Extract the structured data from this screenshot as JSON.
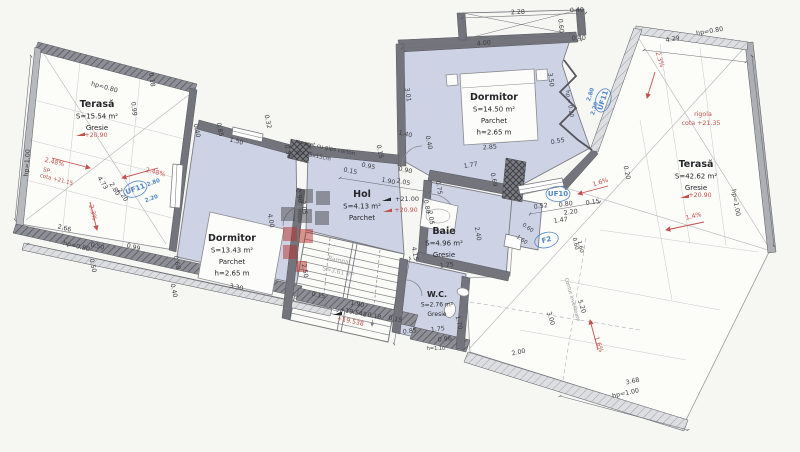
{
  "plan": {
    "language": "Romanian",
    "colors": {
      "paper": "#f6f6f3",
      "room_fill": "#cdd3e5",
      "wall": "#74757c",
      "wall_dark": "#55565c",
      "terrace_fill": "#fcfcf9",
      "dim_text": "#3c3d42",
      "red_annotation": "#c2504b",
      "blue_annotation": "#4f86c6"
    },
    "rooms": [
      {
        "name": "Terasă",
        "area": "S=15.54 m²",
        "finish": "Gresie",
        "x": 97,
        "y": 107
      },
      {
        "name": "Dormitor",
        "area": "S=13.43 m²",
        "finish": "Parchet",
        "height": "h=2.65 m",
        "x": 232,
        "y": 241
      },
      {
        "name": "Hol",
        "area": "S=4.13 m²",
        "finish": "Parchet",
        "x": 362,
        "y": 197
      },
      {
        "name": "Dormitor",
        "area": "S=14.50 m²",
        "finish": "Parchet",
        "height": "h=2.65 m",
        "x": 494,
        "y": 100
      },
      {
        "name": "Baie",
        "area": "S=4.96 m²",
        "finish": "Gresie",
        "x": 444,
        "y": 234
      },
      {
        "name": "W.C.",
        "area": "S=2.76 m²",
        "finish": "Gresie",
        "x": 437,
        "y": 297,
        "small": 1
      },
      {
        "name": "Terasă",
        "area": "S=42.62 m²",
        "finish": "Gresie",
        "x": 696,
        "y": 167
      },
      {
        "name": "Rampa",
        "area": "S=3.61 m²",
        "x": 338,
        "y": 262,
        "r": 12,
        "muted": 1
      }
    ],
    "dimensions": [
      {
        "t": "2.28",
        "x": 518,
        "y": 14,
        "r": -3
      },
      {
        "t": "0.40",
        "x": 577,
        "y": 12,
        "r": -3
      },
      {
        "t": "0.60",
        "x": 559,
        "y": 26,
        "r": 84
      },
      {
        "t": "0.40",
        "x": 579,
        "y": 40,
        "r": -3
      },
      {
        "t": "4.00",
        "x": 484,
        "y": 45,
        "r": -5
      },
      {
        "t": "4.29",
        "x": 673,
        "y": 41,
        "r": -10
      },
      {
        "t": "hp=0.80",
        "x": 710,
        "y": 33,
        "r": -10
      },
      {
        "t": "hp=0.80",
        "x": 104,
        "y": 89,
        "r": 15
      },
      {
        "t": "0.18",
        "x": 150,
        "y": 80,
        "r": 82
      },
      {
        "t": "0.99",
        "x": 132,
        "y": 109,
        "r": 84
      },
      {
        "t": "hp=1.00",
        "x": 29,
        "y": 163,
        "r": -86
      },
      {
        "t": "4.73",
        "x": 101,
        "y": 184,
        "r": 58
      },
      {
        "t": "2.80",
        "x": 113,
        "y": 190,
        "r": 58
      },
      {
        "t": "2.20",
        "x": 121,
        "y": 196,
        "r": 58
      },
      {
        "t": "2.66",
        "x": 64,
        "y": 230,
        "r": 14
      },
      {
        "t": "hp=0.80",
        "x": 76,
        "y": 248,
        "r": 14
      },
      {
        "t": "0.50",
        "x": 97,
        "y": 248,
        "r": 14
      },
      {
        "t": "0.99",
        "x": 133,
        "y": 249,
        "r": 14
      },
      {
        "t": "0.50",
        "x": 91,
        "y": 266,
        "r": 78
      },
      {
        "t": "0.60",
        "x": 175,
        "y": 263,
        "r": 78
      },
      {
        "t": "0.40",
        "x": 172,
        "y": 291,
        "r": 78
      },
      {
        "t": "0.40",
        "x": 195,
        "y": 131,
        "r": 78
      },
      {
        "t": "0.85",
        "x": 218,
        "y": 130,
        "r": 78
      },
      {
        "t": "1.50",
        "x": 236,
        "y": 143,
        "r": 14
      },
      {
        "t": "0.32",
        "x": 266,
        "y": 122,
        "r": 78
      },
      {
        "t": "0.36",
        "x": 286,
        "y": 152,
        "r": 78
      },
      {
        "t": "mascat cu gips carton",
        "x": 325,
        "y": 149,
        "r": 12,
        "s": 5.5
      },
      {
        "t": "gol 25x15cm",
        "x": 313,
        "y": 157,
        "r": 12,
        "s": 5.5
      },
      {
        "t": "3.30",
        "x": 236,
        "y": 289,
        "r": 12
      },
      {
        "t": "0.90",
        "x": 297,
        "y": 196,
        "r": 80
      },
      {
        "t": "2.05",
        "x": 302,
        "y": 208,
        "r": 80
      },
      {
        "t": "4.00",
        "x": 269,
        "y": 221,
        "r": 80
      },
      {
        "t": "2.50",
        "x": 303,
        "y": 271,
        "r": 80
      },
      {
        "t": "4.15",
        "x": 413,
        "y": 254,
        "r": 80
      },
      {
        "t": "0.15",
        "x": 350,
        "y": 173,
        "r": 12
      },
      {
        "t": "0.95",
        "x": 368,
        "y": 168,
        "r": 12
      },
      {
        "t": "1.90",
        "x": 388,
        "y": 183,
        "r": 12
      },
      {
        "t": "2.05",
        "x": 403,
        "y": 184,
        "r": 12
      },
      {
        "t": "0.90",
        "x": 405,
        "y": 172,
        "r": 12
      },
      {
        "t": "1.40",
        "x": 405,
        "y": 136,
        "r": 12
      },
      {
        "t": "0.40",
        "x": 427,
        "y": 143,
        "r": 78
      },
      {
        "t": "0.15",
        "x": 378,
        "y": 152,
        "r": 78
      },
      {
        "t": "+21.00",
        "x": 407,
        "y": 201,
        "s": 6.5
      },
      {
        "t": "2.85",
        "x": 490,
        "y": 149,
        "r": -4
      },
      {
        "t": "1.77",
        "x": 471,
        "y": 167,
        "r": -10
      },
      {
        "t": "0.69",
        "x": 492,
        "y": 180,
        "r": 78
      },
      {
        "t": "3.50",
        "x": 549,
        "y": 80,
        "r": 82
      },
      {
        "t": "3.01",
        "x": 406,
        "y": 95,
        "r": 82
      },
      {
        "t": "0.55",
        "x": 558,
        "y": 143,
        "r": -10
      },
      {
        "t": "hp = 0.20",
        "x": 568,
        "y": 104,
        "r": 80,
        "s": 5.5
      },
      {
        "t": "0.75",
        "x": 437,
        "y": 188,
        "r": 80
      },
      {
        "t": "0.80",
        "x": 425,
        "y": 207,
        "r": 80
      },
      {
        "t": "2.05",
        "x": 429,
        "y": 218,
        "r": 80
      },
      {
        "t": "2.40",
        "x": 476,
        "y": 234,
        "r": 80
      },
      {
        "t": "0.52",
        "x": 541,
        "y": 208,
        "r": -8
      },
      {
        "t": "0.80",
        "x": 566,
        "y": 206,
        "r": -8
      },
      {
        "t": "2.20",
        "x": 571,
        "y": 214,
        "r": -8
      },
      {
        "t": "1.47",
        "x": 561,
        "y": 222,
        "r": -8
      },
      {
        "t": "0.15",
        "x": 593,
        "y": 204,
        "r": -8
      },
      {
        "t": "0.60",
        "x": 527,
        "y": 229,
        "r": 35,
        "s": 5.5
      },
      {
        "t": "1.60",
        "x": 521,
        "y": 241,
        "r": 35,
        "s": 5.5
      },
      {
        "t": "0.60",
        "x": 574,
        "y": 244,
        "r": 78,
        "s": 5.5
      },
      {
        "t": "1.60",
        "x": 579,
        "y": 247,
        "r": 78,
        "s": 5.5
      },
      {
        "t": "0.20",
        "x": 625,
        "y": 173,
        "r": 78
      },
      {
        "t": "1.75",
        "x": 447,
        "y": 267,
        "r": -6
      },
      {
        "t": "1.75",
        "x": 438,
        "y": 331,
        "r": -6
      },
      {
        "t": "0.85",
        "x": 410,
        "y": 333,
        "r": -6
      },
      {
        "t": "1.70",
        "x": 457,
        "y": 323,
        "r": 78
      },
      {
        "t": "0.96",
        "x": 445,
        "y": 341,
        "r": -6
      },
      {
        "t": "h=1.10",
        "x": 436,
        "y": 350,
        "s": 5
      },
      {
        "t": "0.18",
        "x": 374,
        "y": 318,
        "r": 12
      },
      {
        "t": "0.15",
        "x": 395,
        "y": 321,
        "r": 12
      },
      {
        "t": "0.15",
        "x": 318,
        "y": 297,
        "r": 12
      },
      {
        "t": "1.90",
        "x": 357,
        "y": 306,
        "r": 12
      },
      {
        "t": "+19.548",
        "x": 353,
        "y": 314,
        "r": 12
      },
      {
        "t": "2.00",
        "x": 519,
        "y": 354,
        "r": -12
      },
      {
        "t": "3.00",
        "x": 549,
        "y": 319,
        "r": 72
      },
      {
        "t": "5.20",
        "x": 580,
        "y": 307,
        "r": 72
      },
      {
        "t": "Contur învelitoare",
        "x": 571,
        "y": 300,
        "r": 74,
        "s": 5,
        "c": "#8b8c93"
      },
      {
        "t": "3.68",
        "x": 633,
        "y": 383,
        "r": -12
      },
      {
        "t": "hp=1.00",
        "x": 626,
        "y": 395,
        "r": -12
      },
      {
        "t": "hp=1.00",
        "x": 734,
        "y": 203,
        "r": 80
      }
    ],
    "red_annotations": [
      {
        "t": "+20.90",
        "x": 96,
        "y": 137
      },
      {
        "t": "2.48%",
        "x": 54,
        "y": 164,
        "r": 14
      },
      {
        "t": "SP",
        "x": 46,
        "y": 172,
        "r": 14,
        "s": 5.5
      },
      {
        "t": "cota +21.15",
        "x": 56,
        "y": 181,
        "r": 14,
        "s": 5.5
      },
      {
        "t": "2.48%",
        "x": 155,
        "y": 174,
        "r": 14
      },
      {
        "t": "2.3%",
        "x": 91,
        "y": 213,
        "r": 76
      },
      {
        "t": "+20.90",
        "x": 406,
        "y": 212
      },
      {
        "t": "2.3%",
        "x": 658,
        "y": 60,
        "r": 72
      },
      {
        "t": "rigola",
        "x": 703,
        "y": 116
      },
      {
        "t": "cota +21.35",
        "x": 701,
        "y": 125
      },
      {
        "t": "+20.90",
        "x": 700,
        "y": 197
      },
      {
        "t": "1.4%",
        "x": 694,
        "y": 218,
        "r": -14
      },
      {
        "t": "1.6%",
        "x": 601,
        "y": 184,
        "r": -18
      },
      {
        "t": "1.6%",
        "x": 597,
        "y": 345,
        "r": 72
      },
      {
        "t": "+19.538",
        "x": 350,
        "y": 323,
        "r": 12
      }
    ],
    "window_tags": [
      {
        "t": "UF11",
        "x": 136,
        "y": 191,
        "r": -20,
        "circ": 1
      },
      {
        "t": "2.80",
        "x": 154,
        "y": 184,
        "r": -20,
        "s": 5.5
      },
      {
        "t": "2.20",
        "x": 152,
        "y": 200,
        "r": -20,
        "s": 5.5
      },
      {
        "t": "UF11",
        "x": 605,
        "y": 101,
        "r": -72,
        "circ": 1
      },
      {
        "t": "2.80",
        "x": 592,
        "y": 95,
        "r": -72,
        "s": 5.5
      },
      {
        "t": "2.20",
        "x": 596,
        "y": 109,
        "r": -72,
        "s": 5.5
      },
      {
        "t": "UF10",
        "x": 558,
        "y": 196,
        "circ": 1,
        "b": 1
      },
      {
        "t": "F2",
        "x": 547,
        "y": 242,
        "r": -15,
        "circ": 1
      }
    ]
  }
}
